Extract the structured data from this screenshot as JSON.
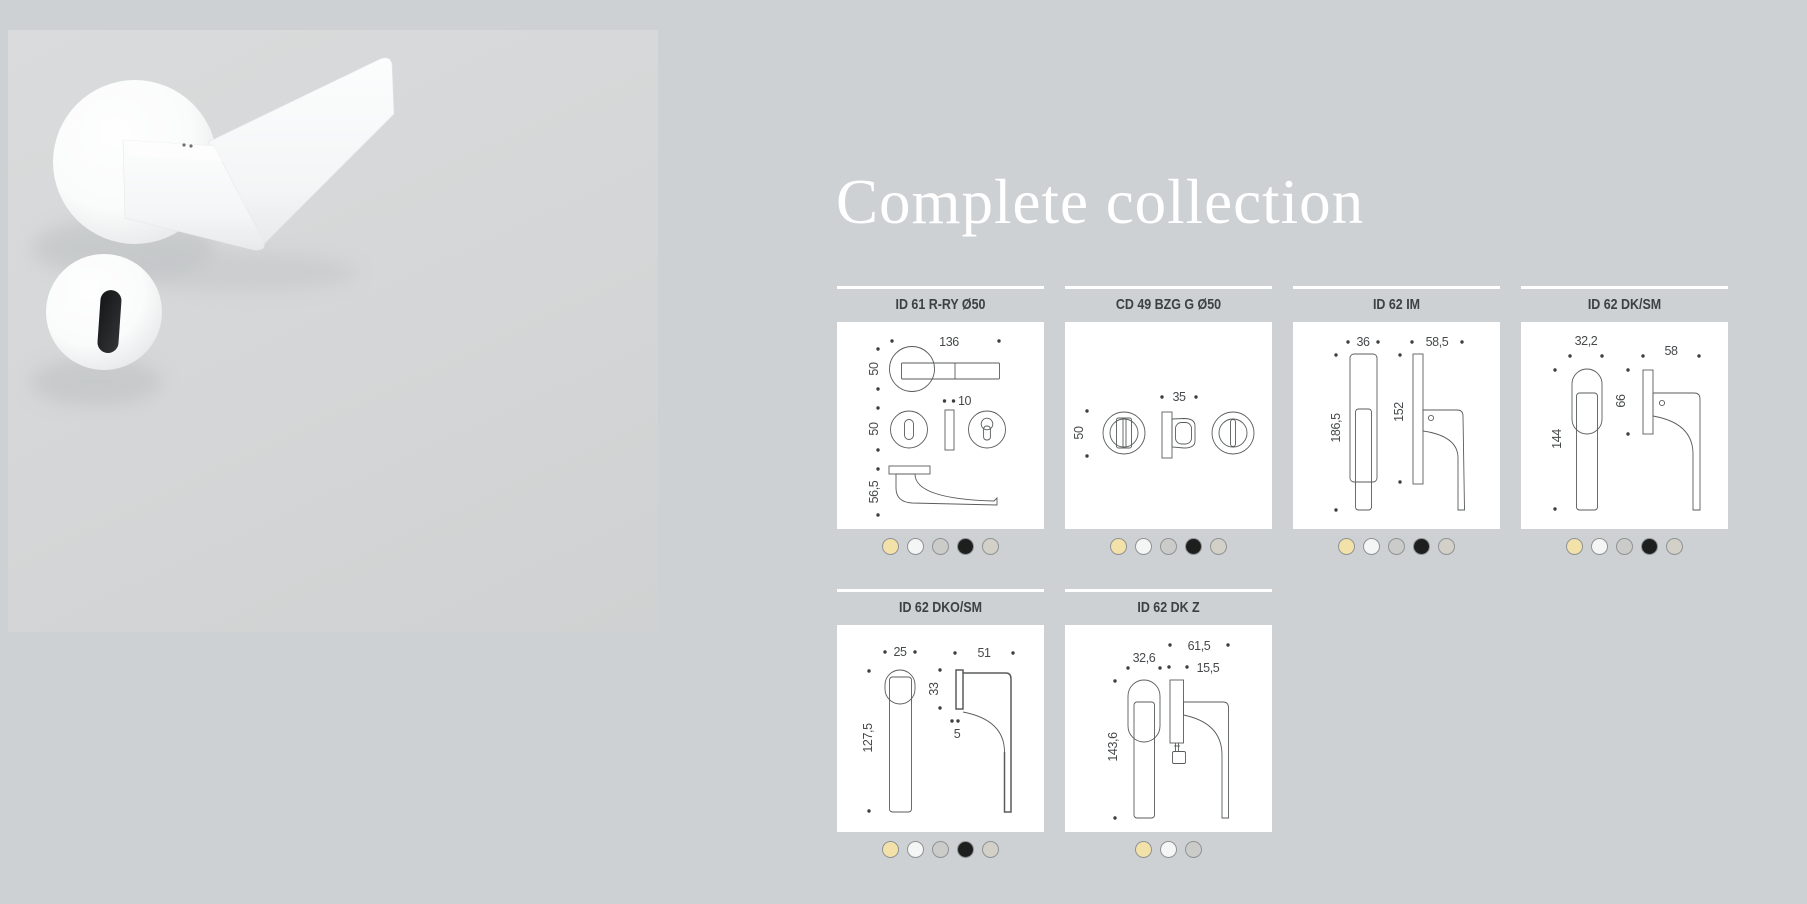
{
  "page": {
    "background": "#cdd1d3"
  },
  "hero": {
    "description": "white lever door handle on round rose with matching keyhole escutcheon",
    "handle_color": "#fbfcfc",
    "keyhole_color": "#1b1c1d"
  },
  "heading": {
    "text": "Complete collection",
    "color": "#ffffff"
  },
  "swatch_palette": {
    "cream": "#f2e1a8",
    "white": "#f4f5f5",
    "gray": "#cbcbc9",
    "black": "#1d1f1f",
    "greige": "#d2d0c7",
    "border": "#8f9394"
  },
  "products": [
    {
      "code": "ID 61 R-RY Ø50",
      "dims": {
        "length": "136",
        "rose": "50",
        "thick": "10",
        "rose2": "50",
        "proj": "56,5"
      },
      "finishes": [
        "cream",
        "white",
        "gray",
        "black",
        "greige"
      ]
    },
    {
      "code": "CD 49 BZG G Ø50",
      "dims": {
        "width": "35",
        "rose": "50"
      },
      "finishes": [
        "cream",
        "white",
        "gray",
        "black",
        "greige"
      ]
    },
    {
      "code": "ID 62 IM",
      "dims": {
        "width": "36",
        "depth": "58,5",
        "height": "186,5",
        "grip": "152"
      },
      "finishes": [
        "cream",
        "white",
        "gray",
        "black",
        "greige"
      ]
    },
    {
      "code": "ID 62 DK/SM",
      "dims": {
        "width": "32,2",
        "depth": "58",
        "plate": "66",
        "height": "144"
      },
      "finishes": [
        "cream",
        "white",
        "gray",
        "black",
        "greige"
      ]
    },
    {
      "code": "ID 62 DKO/SM",
      "dims": {
        "width": "25",
        "depth": "51",
        "plate": "33",
        "gap": "5",
        "height": "127,5"
      },
      "finishes": [
        "cream",
        "white",
        "gray",
        "black",
        "greige"
      ]
    },
    {
      "code": "ID 62 DK Z",
      "dims": {
        "width": "32,6",
        "depth": "61,5",
        "gap": "15,5",
        "height": "143,6"
      },
      "finishes": [
        "cream",
        "white",
        "gray"
      ]
    }
  ]
}
